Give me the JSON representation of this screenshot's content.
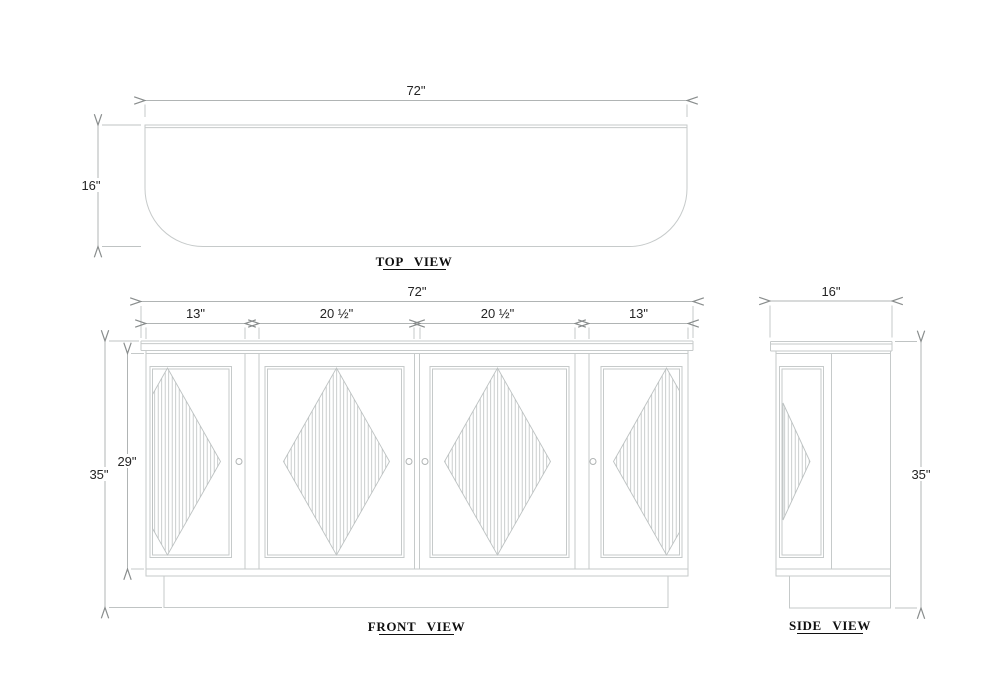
{
  "drawing": {
    "top_view": {
      "title": "TOP VIEW",
      "width_dim": "72\"",
      "depth_dim": "16\""
    },
    "front_view": {
      "title": "FRONT VIEW",
      "overall_width_dim": "72\"",
      "section_dims": [
        "13\"",
        "20 ½\"",
        "20 ½\"",
        "13\""
      ],
      "overall_height_dim": "35\"",
      "door_opening_height_dim": "29\""
    },
    "side_view": {
      "title": "SIDE VIEW",
      "depth_dim": "16\"",
      "height_dim": "35\""
    },
    "colors": {
      "background": "#ffffff",
      "object_line": "#c6caca",
      "dimension_line": "#b0b4b4",
      "arrowhead": "#898d8d",
      "hatch_line": "#bdc2c2",
      "text": "#242424",
      "title_text": "#101010"
    }
  }
}
